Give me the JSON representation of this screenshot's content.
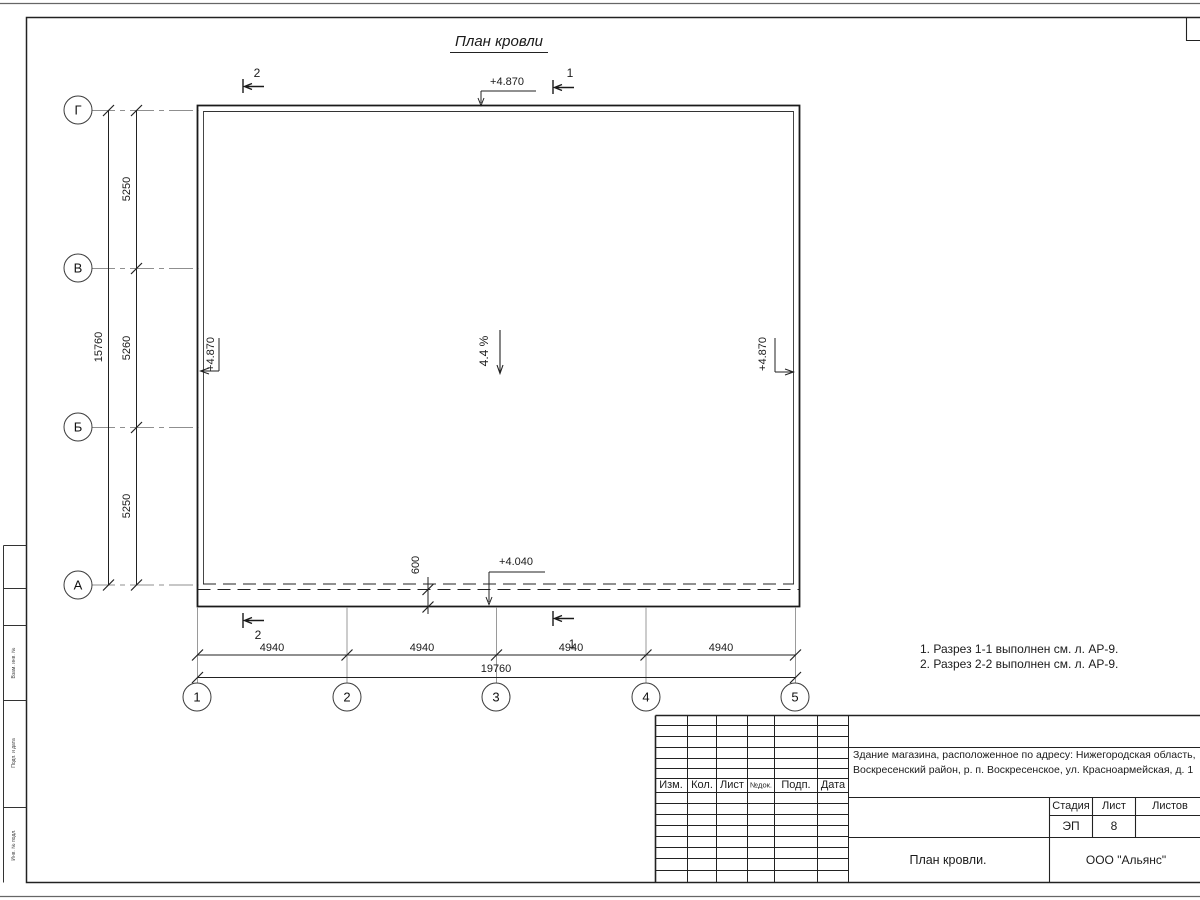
{
  "page": {
    "title": "План кровли"
  },
  "axes": {
    "rows": [
      "Г",
      "В",
      "Б",
      "А"
    ],
    "cols": [
      "1",
      "2",
      "3",
      "4",
      "5"
    ]
  },
  "dimensions": {
    "row_spans": [
      "5250",
      "5260",
      "5250"
    ],
    "row_total": "15760",
    "col_spans": [
      "4940",
      "4940",
      "4940",
      "4940"
    ],
    "col_total": "19760",
    "overhang": "600"
  },
  "marks": {
    "elev_top": "+4.870",
    "elev_left": "+4.870",
    "elev_right": "+4.870",
    "elev_low": "+4.040",
    "slope": "4.4 %",
    "section_1": "1",
    "section_2": "2"
  },
  "notes": {
    "line1": "1. Разрез 1-1 выполнен см. л. АР-9.",
    "line2": "2. Разрез 2-2 выполнен см. л. АР-9."
  },
  "titleblock": {
    "cols": [
      "Изм.",
      "Кол.",
      "Лист",
      "№док.",
      "Подп.",
      "Дата"
    ],
    "desc1": "Здание магазина, расположенное по адресу: Нижегородская область,",
    "desc2": "Воскресенский район, р. п. Воскресенское, ул. Красноармейская, д. 1",
    "stage_label": "Стадия",
    "sheet_label": "Лист",
    "sheets_label": "Листов",
    "stage": "ЭП",
    "sheet": "8",
    "doc_title": "План кровли.",
    "company": "ООО \"Альянс\""
  },
  "margin": {
    "c1": "Взам. инв. №",
    "c2": "Подп. и дата",
    "c3": "Инв. № подл."
  }
}
